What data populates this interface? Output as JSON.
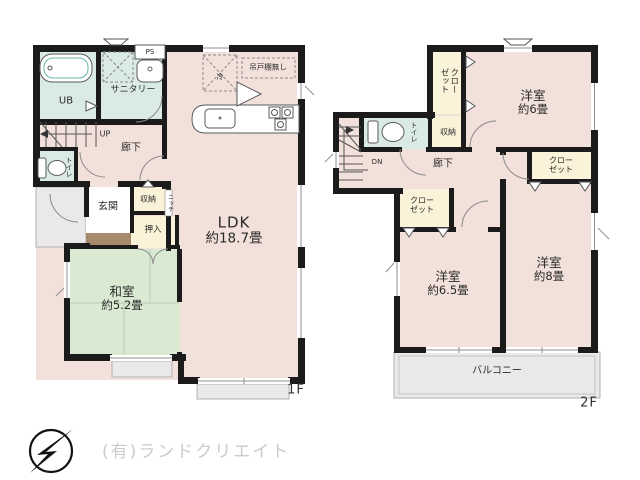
{
  "floor1": {
    "label": "1F",
    "rooms": {
      "ub": "UB",
      "sanitary": "サニタリー",
      "ps": "PS",
      "up": "UP",
      "hallway": "廊下",
      "toilet": "トイレ",
      "genkan": "玄関",
      "storage": "収納",
      "niche": "ニッチ",
      "oshiire": "押入",
      "washitsu_name": "和室",
      "washitsu_size": "約5.2畳",
      "ldk_name": "LDK",
      "ldk_size": "約18.7畳",
      "fridge": "冷",
      "no_hanging_cupboard": "吊戸棚無し"
    }
  },
  "floor2": {
    "label": "2F",
    "rooms": {
      "closet_vertical_line1": "クロー",
      "closet_vertical_line2": "ゼット",
      "toilet": "トイレ",
      "storage": "収納",
      "dn": "DN",
      "hallway": "廊下",
      "closet_left_line1": "クロー",
      "closet_left_line2": "ゼット",
      "closet_right_line1": "クロー",
      "closet_right_line2": "ゼット",
      "bedroom6_name": "洋室",
      "bedroom6_size": "約6畳",
      "bedroom65_name": "洋室",
      "bedroom65_size": "約6.5畳",
      "bedroom8_name": "洋室",
      "bedroom8_size": "約8畳",
      "balcony": "バルコニー"
    }
  },
  "footer": {
    "company": "(有)ランドクリエイト",
    "compass_icon": "north-arrow-compass"
  },
  "colors": {
    "room_pink": "#f2e1da",
    "wet_mint": "#d9ebe2",
    "tatami_green": "#d9e9d2",
    "closet_cream": "#faf3d9",
    "outdoor_gray": "#eae8ea",
    "step_brown": "#a8896b",
    "bathtub_teal": "#85d1c6",
    "wall_black": "#1b1b1b"
  }
}
